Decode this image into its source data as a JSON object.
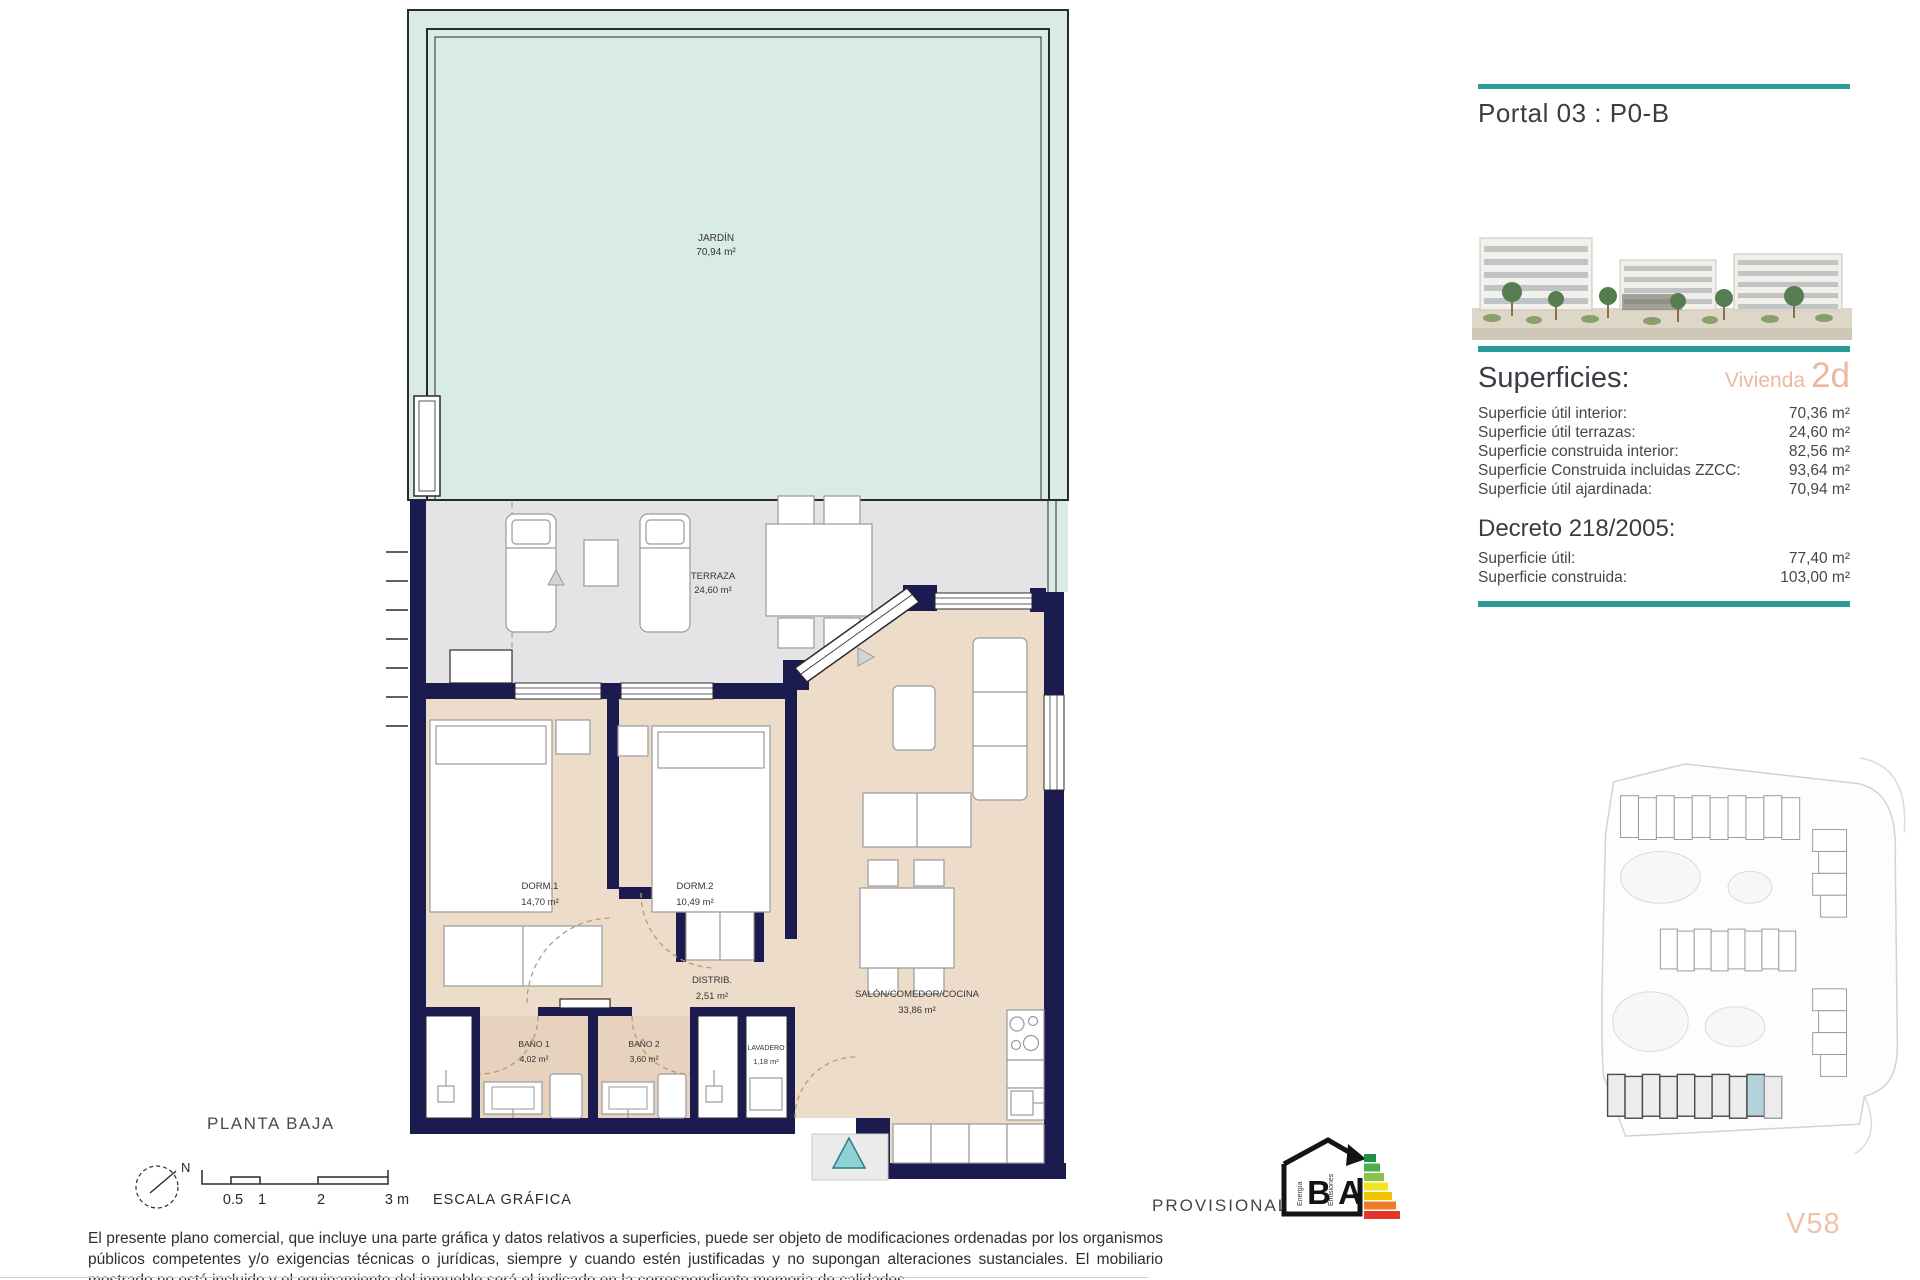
{
  "colors": {
    "teal": "#2b9b98",
    "salmon": "#eab9a0",
    "navy": "#1b1b4f",
    "mint": "#d9ece4",
    "terrace_gray": "#e4e4e6",
    "interior_beige": "#eedccb",
    "bath_beige": "#e7d2bd"
  },
  "header": {
    "title": "Portal 03 : P0-B"
  },
  "superficies": {
    "heading": "Superficies:",
    "vivienda_label": "Vivienda",
    "vivienda_value": "2d",
    "rows": [
      {
        "label": "Superficie útil interior:",
        "value": "70,36 m²"
      },
      {
        "label": "Superficie útil terrazas:",
        "value": "24,60 m²"
      },
      {
        "label": "Superficie construida interior:",
        "value": "82,56 m²"
      },
      {
        "label": "Superficie Construida incluidas ZZCC:",
        "value": "93,64 m²"
      },
      {
        "label": "Superficie útil ajardinada:",
        "value": "70,94 m²"
      }
    ]
  },
  "decreto": {
    "heading": "Decreto 218/2005:",
    "rows": [
      {
        "label": "Superficie útil:",
        "value": "77,40 m²"
      },
      {
        "label": "Superficie construida:",
        "value": "103,00 m²"
      }
    ]
  },
  "plan": {
    "floor_label": "PLANTA BAJA",
    "rooms": {
      "jardin": {
        "name": "JARDÍN",
        "area": "70,94 m²"
      },
      "terraza": {
        "name": "TERRAZA",
        "area": "24,60 m²"
      },
      "dorm1": {
        "name": "DORM.1",
        "area": "14,70 m²"
      },
      "dorm2": {
        "name": "DORM.2",
        "area": "10,49 m²"
      },
      "distrib": {
        "name": "DISTRIB.",
        "area": "2,51 m²"
      },
      "salon": {
        "name": "SALÓN/COMEDOR/COCINA",
        "area": "33,86 m²"
      },
      "bano1": {
        "name": "BAÑO 1",
        "area": "4,02 m²"
      },
      "bano2": {
        "name": "BAÑO 2",
        "area": "3,60 m²"
      },
      "lavadero": {
        "name": "LAVADERO",
        "area": "1,18 m²"
      }
    }
  },
  "scalebar": {
    "ticks": [
      "0.5",
      "1",
      "2",
      "3 m"
    ],
    "label": "ESCALA GRÁFICA",
    "north": "N"
  },
  "energy": {
    "status": "PROVISIONAL",
    "letters": [
      "B",
      "A"
    ],
    "captions": [
      "Energía",
      "Emisiones"
    ]
  },
  "footer": {
    "unit_code": "V58",
    "disclaimer": "El presente plano comercial, que incluye una parte gráfica y datos relativos a superficies, puede ser objeto de modificaciones ordenadas por los organismos públicos competentes y/o exigencias técnicas o jurídicas, siempre y cuando estén justificadas y no supongan alteraciones sustanciales. El mobiliario mostrado no está incluido y el equipamiento del inmueble será el indicado en la correspondiente memoria de calidades."
  }
}
